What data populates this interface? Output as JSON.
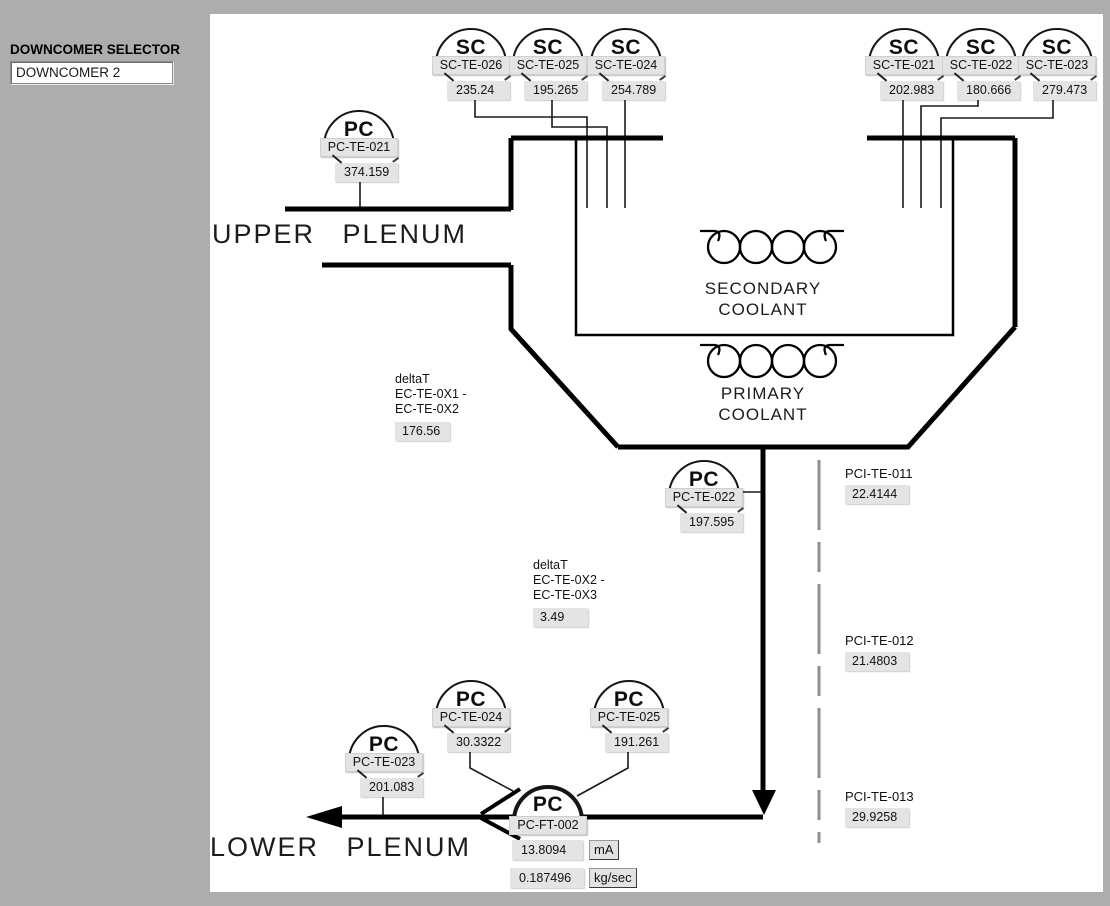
{
  "window": {
    "background": "#adadad",
    "canvas": "#ffffff",
    "line_color": "#000000",
    "dashed_line_color": "#8f8f8f",
    "box_fill": "#e4e4e4"
  },
  "selector": {
    "label": "DOWNCOMER SELECTOR",
    "value": "DOWNCOMER 2"
  },
  "regions": {
    "upper_plenum": "UPPER PLENUM",
    "lower_plenum": "LOWER PLENUM"
  },
  "heat_exchanger": {
    "secondary_line1": "SECONDARY",
    "secondary_line2": "COOLANT",
    "primary_line1": "PRIMARY",
    "primary_line2": "COOLANT"
  },
  "sensors": [
    {
      "glyph": "SC",
      "tag": "SC-TE-026",
      "value": "235.24"
    },
    {
      "glyph": "SC",
      "tag": "SC-TE-025",
      "value": "195.265"
    },
    {
      "glyph": "SC",
      "tag": "SC-TE-024",
      "value": "254.789"
    },
    {
      "glyph": "SC",
      "tag": "SC-TE-021",
      "value": "202.983"
    },
    {
      "glyph": "SC",
      "tag": "SC-TE-022",
      "value": "180.666"
    },
    {
      "glyph": "SC",
      "tag": "SC-TE-023",
      "value": "279.473"
    },
    {
      "glyph": "PC",
      "tag": "PC-TE-021",
      "value": "374.159"
    },
    {
      "glyph": "PC",
      "tag": "PC-TE-022",
      "value": "197.595"
    },
    {
      "glyph": "PC",
      "tag": "PC-TE-024",
      "value": "30.3322"
    },
    {
      "glyph": "PC",
      "tag": "PC-TE-025",
      "value": "191.261"
    },
    {
      "glyph": "PC",
      "tag": "PC-TE-023",
      "value": "201.083"
    }
  ],
  "pci_sensors": [
    {
      "tag": "PCI-TE-011",
      "value": "22.4144"
    },
    {
      "tag": "PCI-TE-012",
      "value": "21.4803"
    },
    {
      "tag": "PCI-TE-013",
      "value": "29.9258"
    }
  ],
  "delta_t": [
    {
      "title": "deltaT",
      "line1": "EC-TE-0X1 -",
      "line2": "EC-TE-0X2",
      "value": "176.56"
    },
    {
      "title": "deltaT",
      "line1": "EC-TE-0X2 -",
      "line2": "EC-TE-0X3",
      "value": "3.49"
    }
  ],
  "flow_transmitter": {
    "glyph": "PC",
    "tag": "PC-FT-002",
    "current_value": "13.8094",
    "current_unit": "mA",
    "flow_value": "0.187496",
    "flow_unit": "kg/sec"
  }
}
